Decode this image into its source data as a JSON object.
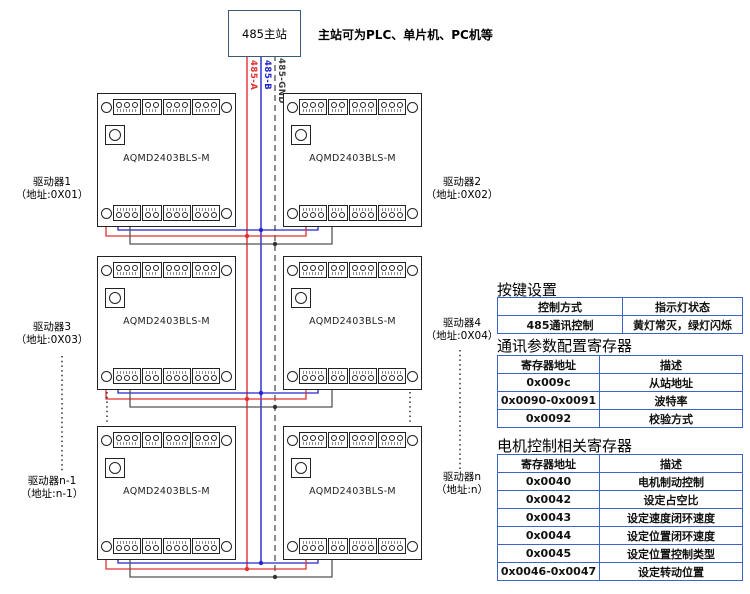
{
  "master": {
    "label": "485主站",
    "note": "主站可为PLC、单片机、PC机等"
  },
  "bus": {
    "a_label": "485-A",
    "b_label": "485-B",
    "gnd_label": "485-GND",
    "a_color": "#e03030",
    "b_color": "#2525cc",
    "gnd_color": "#3a3a3a"
  },
  "board_model": "AQMD2403BLS-M",
  "drivers": [
    {
      "name": "驱动器1",
      "addr": "（地址:0X01）"
    },
    {
      "name": "驱动器2",
      "addr": "（地址:0X02）"
    },
    {
      "name": "驱动器3",
      "addr": "（地址:0X03）"
    },
    {
      "name": "驱动器4",
      "addr": "（地址:0X04）"
    },
    {
      "name": "驱动器n-1",
      "addr": "（地址:n-1）"
    },
    {
      "name": "驱动器n",
      "addr": "（地址:n）"
    }
  ],
  "tables": {
    "keys": {
      "title": "按键设置",
      "headers": [
        "控制方式",
        "指示灯状态"
      ],
      "rows": [
        [
          "485通讯控制",
          "黄灯常灭，绿灯闪烁"
        ]
      ]
    },
    "comm": {
      "title": "通讯参数配置寄存器",
      "headers": [
        "寄存器地址",
        "描述"
      ],
      "rows": [
        [
          "0x009c",
          "从站地址"
        ],
        [
          "0x0090-0x0091",
          "波特率"
        ],
        [
          "0x0092",
          "校验方式"
        ]
      ]
    },
    "motor": {
      "title": "电机控制相关寄存器",
      "headers": [
        "寄存器地址",
        "描述"
      ],
      "rows": [
        [
          "0x0040",
          "电机制动控制"
        ],
        [
          "0x0042",
          "设定占空比"
        ],
        [
          "0x0043",
          "设定速度闭环速度"
        ],
        [
          "0x0044",
          "设定位置闭环速度"
        ],
        [
          "0x0045",
          "设定位置控制类型"
        ],
        [
          "0x0046-0x0047",
          "设定转动位置"
        ]
      ]
    }
  },
  "table_border_color": "#3c64c8",
  "master_border_color": "#3a5878"
}
